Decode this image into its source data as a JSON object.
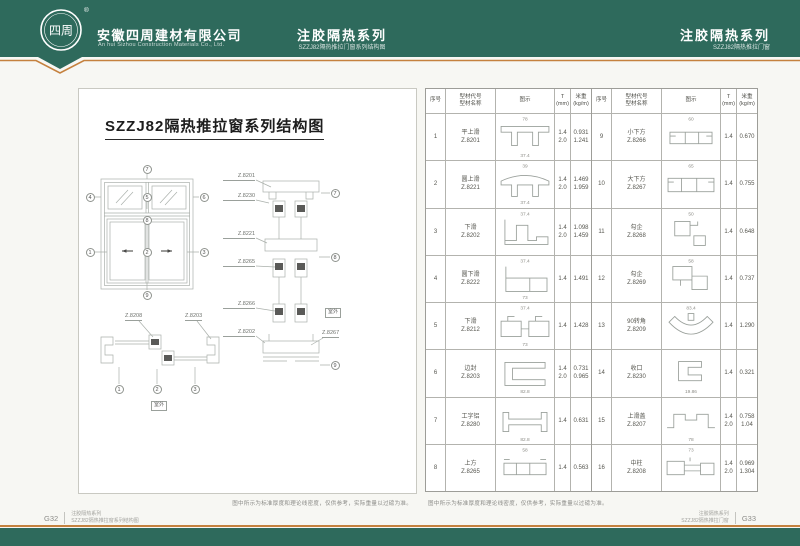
{
  "colors": {
    "brand_green": "#2e6a5c",
    "accent_orange": "#c5813e",
    "line_gray": "#9aa09b"
  },
  "header": {
    "logo": {
      "chars": "四周",
      "registered": "®"
    },
    "company": {
      "name_cn": "安徽四周建材有限公司",
      "name_en": "An hui Sizhou Construction Materials Co., Ltd."
    },
    "center": {
      "title": "注胶隔热系列",
      "subtitle": "SZZJ82隔热推拉门窗系列结构图"
    },
    "right": {
      "title": "注胶隔热系列",
      "subtitle": "SZZJ82隔热推拉门窗"
    }
  },
  "left_page": {
    "title": "SZZJ82隔热推拉窗系列结构图",
    "callouts": {
      "c1": "1",
      "c2": "2",
      "c3": "3",
      "c4": "4",
      "c5": "5",
      "c6": "6",
      "c7": "7",
      "c8": "8",
      "c9": "9"
    },
    "section_labels": [
      "Z.8201",
      "Z.8230",
      "Z.8221",
      "Z.8265",
      "Z.8266",
      "Z.8202"
    ],
    "section_label_right": "Z.8267",
    "hsection_labels": [
      "Z.8208",
      "Z.8203"
    ],
    "outdoor_label": "室外",
    "note": "图中所示为标准厚度和理论线密度，仅供参考，实际重量以过磅为准。"
  },
  "table": {
    "headers": {
      "no": "序号",
      "name1": "型材代号",
      "name2": "型材名称",
      "diagram": "图示",
      "t1": "T",
      "t2": "(mm)",
      "w1": "米重",
      "w2": "(kg/m)"
    },
    "rows": [
      {
        "no": "1",
        "name": "平上滑",
        "code": "Z.8201",
        "icon": "flat-top-track",
        "dim_top": "78",
        "dim_bottom": "37.4",
        "t": [
          "1.4",
          "2.0"
        ],
        "w": [
          "0.931",
          "1.241"
        ]
      },
      {
        "no": "2",
        "name": "圆上滑",
        "code": "Z.8221",
        "icon": "round-top-track",
        "dim_top": "39",
        "dim_bottom": "37.4",
        "t": [
          "1.4",
          "2.0"
        ],
        "w": [
          "1.469",
          "1.959"
        ]
      },
      {
        "no": "3",
        "name": "下滑",
        "code": "Z.8202",
        "icon": "bottom-track-step",
        "dim_top": "37.4",
        "dim_bottom": "",
        "t": [
          "1.4",
          "2.0"
        ],
        "w": [
          "1.098",
          "1.459"
        ]
      },
      {
        "no": "4",
        "name": "圆下滑",
        "code": "Z.8222",
        "icon": "round-bottom-track",
        "dim_top": "37.4",
        "dim_bottom": "73",
        "t": [
          "1.4"
        ],
        "w": [
          "1.491"
        ]
      },
      {
        "no": "5",
        "name": "下滑",
        "code": "Z.8212",
        "icon": "twin-box-track",
        "dim_top": "37.4",
        "dim_bottom": "73",
        "t": [
          "1.4"
        ],
        "w": [
          "1.428"
        ]
      },
      {
        "no": "6",
        "name": "边封",
        "code": "Z.8203",
        "icon": "side-seal",
        "dim_top": "",
        "dim_bottom": "82.8",
        "t": [
          "1.4",
          "2.0"
        ],
        "w": [
          "0.731",
          "0.965"
        ]
      },
      {
        "no": "7",
        "name": "工字铝",
        "code": "Z.8280",
        "icon": "i-beam",
        "dim_top": "",
        "dim_bottom": "82.8",
        "t": [
          "1.4"
        ],
        "w": [
          "0.631"
        ]
      },
      {
        "no": "8",
        "name": "上方",
        "code": "Z.8265",
        "icon": "top-rail-box",
        "dim_top": "58",
        "dim_bottom": "",
        "t": [
          "1.4"
        ],
        "w": [
          "0.563"
        ]
      },
      {
        "no": "9",
        "name": "小下方",
        "code": "Z.8266",
        "icon": "small-bottom-rail",
        "dim_top": "60",
        "dim_bottom": "",
        "t": [
          "1.4"
        ],
        "w": [
          "0.670"
        ]
      },
      {
        "no": "10",
        "name": "大下方",
        "code": "Z.8267",
        "icon": "big-bottom-rail",
        "dim_top": "65",
        "dim_bottom": "",
        "t": [
          "1.4"
        ],
        "w": [
          "0.755"
        ]
      },
      {
        "no": "11",
        "name": "勾企",
        "code": "Z.8268",
        "icon": "hook-stile-a",
        "dim_top": "50",
        "dim_bottom": "",
        "t": [
          "1.4"
        ],
        "w": [
          "0.648"
        ]
      },
      {
        "no": "12",
        "name": "勾企",
        "code": "Z.8269",
        "icon": "hook-stile-b",
        "dim_top": "58",
        "dim_bottom": "",
        "t": [
          "1.4"
        ],
        "w": [
          "0.737"
        ]
      },
      {
        "no": "13",
        "name": "90转角",
        "code": "Z.8209",
        "icon": "corner-90",
        "dim_top": "83.4",
        "dim_bottom": "",
        "t": [
          "1.4"
        ],
        "w": [
          "1.290"
        ]
      },
      {
        "no": "14",
        "name": "收口",
        "code": "Z.8230",
        "icon": "end-cap",
        "dim_top": "",
        "dim_bottom": "19.86",
        "t": [
          "1.4"
        ],
        "w": [
          "0.321"
        ]
      },
      {
        "no": "15",
        "name": "上滑盖",
        "code": "Z.8207",
        "icon": "top-cover",
        "dim_top": "",
        "dim_bottom": "78",
        "t": [
          "1.4",
          "2.0"
        ],
        "w": [
          "0.758",
          "1.04"
        ]
      },
      {
        "no": "16",
        "name": "中柱",
        "code": "Z.8208",
        "icon": "mullion",
        "dim_top": "73",
        "dim_bottom": "",
        "t": [
          "1.4",
          "2.0"
        ],
        "w": [
          "0.969",
          "1.304"
        ]
      }
    ],
    "note": "图中所示为标准厚度和理论线密度，仅供参考，实际重量以过磅为准。"
  },
  "footer": {
    "left": {
      "page": "G32",
      "line1": "注胶隔热系列",
      "line2": "SZZJ82隔热推拉窗系列结构图"
    },
    "right": {
      "page": "G33",
      "line1": "注胶隔热系列",
      "line2": "SZZJ82隔热推拉门窗"
    }
  }
}
